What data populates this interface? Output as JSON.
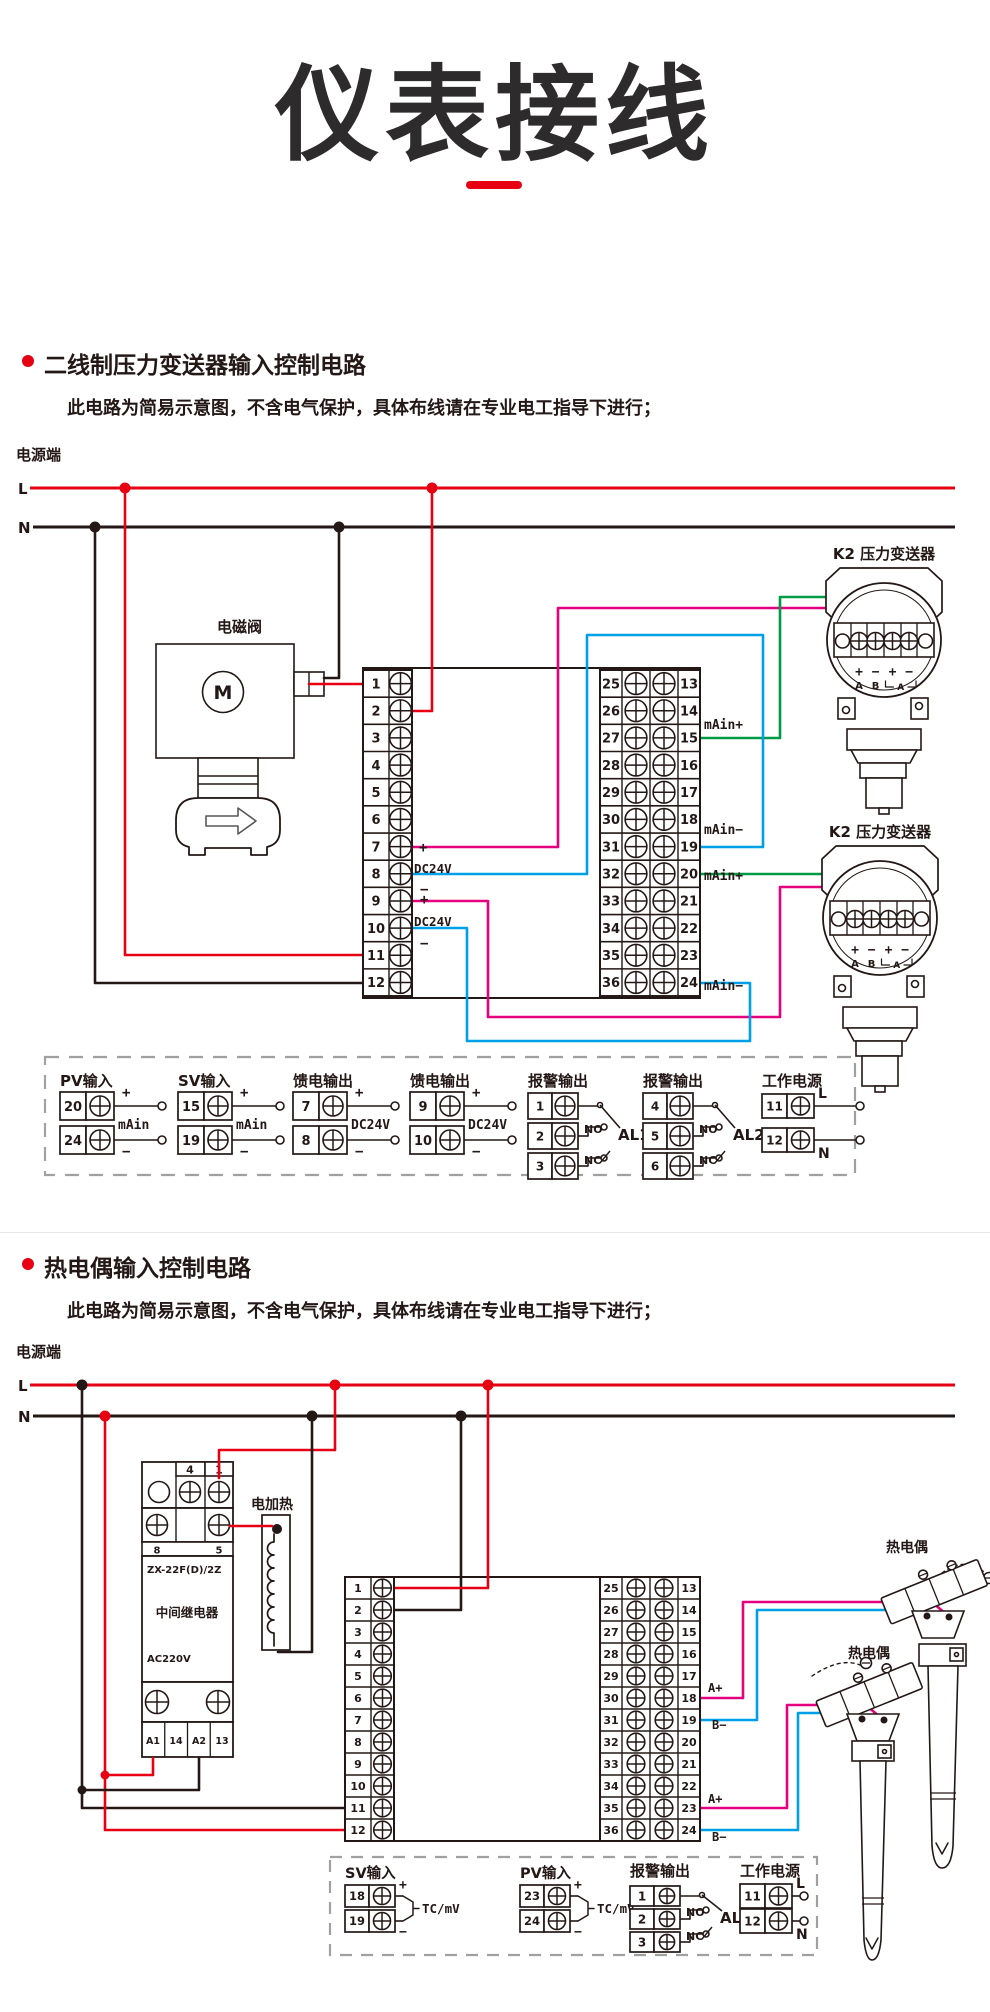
{
  "title": "仪表接线",
  "colors": {
    "red": "#e60012",
    "black": "#231815",
    "magenta": "#e4007f",
    "blue": "#00a0e9",
    "green": "#009944",
    "gray": "#9fa0a0"
  },
  "s1": {
    "heading": "二线制压力变送器输入控制电路",
    "note": "此电路为简易示意图，不含电气保护，具体布线请在专业电工指导下进行；",
    "power": "电源端",
    "lineL": "L",
    "lineN": "N",
    "solenoid": "电磁阀",
    "motor": "M",
    "tx1": "K2 压力变送器",
    "tx2": "K2 压力变送器",
    "txSigns": [
      "+",
      "−",
      "+",
      "−"
    ],
    "txAB": [
      "A",
      "B"
    ],
    "txBracket": "A",
    "stripL": [
      "1",
      "2",
      "3",
      "4",
      "5",
      "6",
      "7",
      "8",
      "9",
      "10",
      "11",
      "12"
    ],
    "stripRouter": [
      "25",
      "26",
      "27",
      "28",
      "29",
      "30",
      "31",
      "32",
      "33",
      "34",
      "35",
      "36"
    ],
    "stripRinner": [
      "13",
      "14",
      "15",
      "16",
      "17",
      "18",
      "19",
      "20",
      "21",
      "22",
      "23",
      "24"
    ],
    "leftAnn": [
      "+",
      "DC24V",
      "−",
      "+",
      "DC24V",
      "−"
    ],
    "rightAnn": [
      "mAin+",
      "mAin−",
      "mAin+",
      "mAin−"
    ],
    "legend": [
      {
        "type": "pair",
        "title": "PV输入",
        "rows": [
          [
            "20",
            "+"
          ],
          [
            "24",
            "−"
          ]
        ],
        "mid": "mAin"
      },
      {
        "type": "pair",
        "title": "SV输入",
        "rows": [
          [
            "15",
            "+"
          ],
          [
            "19",
            "−"
          ]
        ],
        "mid": "mAin"
      },
      {
        "type": "pair",
        "title": "馈电输出",
        "rows": [
          [
            "7",
            "+"
          ],
          [
            "8",
            "−"
          ]
        ],
        "mid": "DC24V"
      },
      {
        "type": "pair",
        "title": "馈电输出",
        "rows": [
          [
            "9",
            "+"
          ],
          [
            "10",
            "−"
          ]
        ],
        "mid": "DC24V"
      },
      {
        "type": "alarm",
        "title": "报警输出",
        "rows": [
          "1",
          "2",
          "3"
        ],
        "no": "NO",
        "nc": "NC",
        "name": "AL1"
      },
      {
        "type": "alarm",
        "title": "报警输出",
        "rows": [
          "4",
          "5",
          "6"
        ],
        "no": "NO",
        "nc": "NC",
        "name": "AL2"
      },
      {
        "type": "power",
        "title": "工作电源",
        "rows": [
          [
            "11",
            "L"
          ],
          [
            "12",
            "N"
          ]
        ]
      }
    ]
  },
  "s2": {
    "heading": "热电偶输入控制电路",
    "note": "此电路为简易示意图，不含电气保护，具体布线请在专业电工指导下进行；",
    "power": "电源端",
    "lineL": "L",
    "lineN": "N",
    "heater": "电加热",
    "relay": {
      "model": "ZX-22F(D)/2Z",
      "name": "中间继电器",
      "volt": "AC220V",
      "top": [
        "4",
        "1"
      ],
      "mid": [
        "8",
        "5"
      ],
      "bottom": [
        "A1",
        "14",
        "A2",
        "13"
      ]
    },
    "tc1": "热电偶",
    "tc2": "热电偶",
    "stripL": [
      "1",
      "2",
      "3",
      "4",
      "5",
      "6",
      "7",
      "8",
      "9",
      "10",
      "11",
      "12"
    ],
    "stripRouter": [
      "25",
      "26",
      "27",
      "28",
      "29",
      "30",
      "31",
      "32",
      "33",
      "34",
      "35",
      "36"
    ],
    "stripRinner": [
      "13",
      "14",
      "15",
      "16",
      "17",
      "18",
      "19",
      "20",
      "21",
      "22",
      "23",
      "24"
    ],
    "rightAnn": [
      "A+",
      "B−",
      "A+",
      "B−"
    ],
    "legend": [
      {
        "type": "pair2",
        "title": "SV输入",
        "rows": [
          [
            "18",
            "+"
          ],
          [
            "19",
            "−"
          ]
        ],
        "mid": "TC/mV"
      },
      {
        "type": "pair2",
        "title": "PV输入",
        "rows": [
          [
            "23",
            "+"
          ],
          [
            "24",
            "−"
          ]
        ],
        "mid": "TC/mV"
      },
      {
        "type": "alarm",
        "title": "报警输出",
        "rows": [
          "1",
          "2",
          "3"
        ],
        "no": "NO",
        "nc": "NC",
        "name": "AL1"
      },
      {
        "type": "power",
        "title": "工作电源",
        "rows": [
          [
            "11",
            "L"
          ],
          [
            "12",
            "N"
          ]
        ]
      }
    ]
  }
}
